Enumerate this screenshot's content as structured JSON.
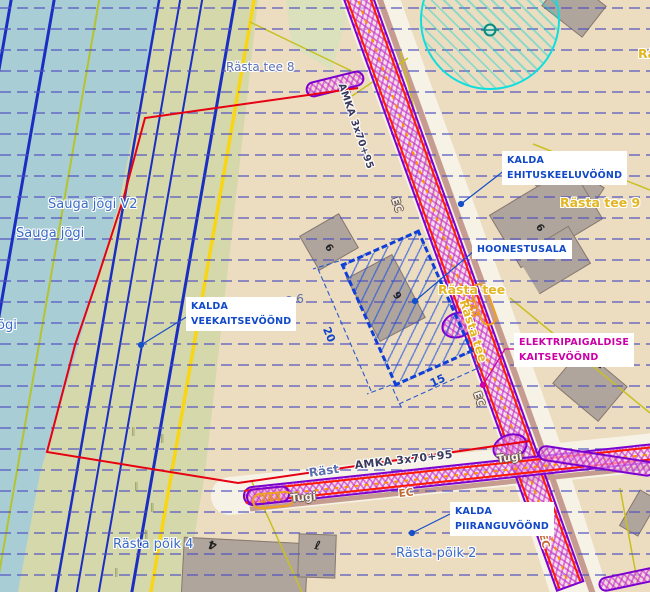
{
  "annotations": {
    "ehituskeeluvoond": {
      "line1": "KALDA",
      "line2": "EHITUSKEELUVÖÖND"
    },
    "hoonestusala": {
      "label": "HOONESTUSALA"
    },
    "veekaitsevoond": {
      "line1": "KALDA",
      "line2": "VEEKAITSEVÖÖND"
    },
    "elektripaigaldise": {
      "line1": "ELEKTRIPAIGALDISE",
      "line2": "KAITSEVÖÖND"
    },
    "piiranguvoond": {
      "line1": "KALDA",
      "line2": "PIIRANGUVÖÖND"
    }
  },
  "streets": {
    "rasta_tee_8": "Rästa tee 8",
    "rasta_tee_9": "Rästa tee 9",
    "rasta_tee": "Rästa tee",
    "rasta_tee_clipped": "Rä",
    "rasta_tee_6_partial": "e 6",
    "rasta_poik_4": "Rästa põik 4",
    "rasta_poik_2": "Rästa põik 2",
    "rasta_partial": "Räst"
  },
  "water_labels": {
    "sauga_jogi_v2": "Sauga jõgi V2",
    "sauga_jogi": "Sauga jõgi",
    "jogi_partial": "õgi"
  },
  "utility": {
    "cable": "AMKA 3x70+95",
    "ec": "EC",
    "tugi": "Tugi",
    "pole_number": "244"
  },
  "dimensions": {
    "side_long": "20",
    "side_short": "15"
  },
  "building_numbers": {
    "rasta9_house": "6",
    "small_house": "6",
    "hatch_house": "9",
    "poik4_house": "4",
    "poik4_outbuilding": "ℓ",
    "right_house": "7"
  },
  "grass_mark": "‖",
  "colors": {
    "water": "#a9cdd5",
    "meadow_green": "#d5d8aa",
    "base_beige": "#ecdcc0",
    "grid_blue": "#5050c0",
    "flow_blue": "#1a2ec2",
    "boundary_red": "#e60012",
    "cable_plaid_magenta": "#c628c4",
    "protection_purple": "#7c00d0",
    "annotation_blue": "#1149c8",
    "annotation_magenta": "#cc00a6",
    "street_yellow": "#e3b520",
    "street_blue": "#3a6bc6",
    "cadastral_yellow": "#c8c020",
    "circle_cyan": "#10dede",
    "orange_marker": "#f0a020"
  }
}
